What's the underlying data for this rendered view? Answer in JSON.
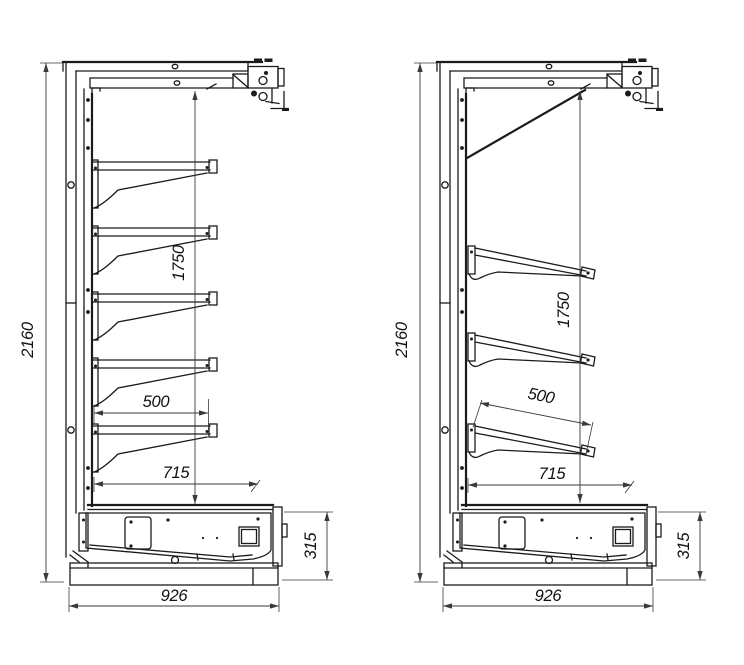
{
  "drawing": {
    "type": "technical-drawing",
    "description": "Two side-section views of a wall shelving / refrigerated multideck unit with dimensions",
    "views": [
      {
        "name": "side-view-horizontal-shelves",
        "shelf_count": 5,
        "dims": {
          "overall_height": "2160",
          "inner_height": "1750",
          "shelf_depth": "500",
          "deck_depth": "715",
          "base_height": "315",
          "overall_depth": "926"
        }
      },
      {
        "name": "side-view-inclined-shelves",
        "shelf_count": 3,
        "dims": {
          "overall_height": "2160",
          "inner_height": "1750",
          "shelf_depth": "500",
          "deck_depth": "715",
          "base_height": "315",
          "overall_depth": "926"
        }
      }
    ],
    "colors": {
      "background": "#ffffff",
      "line": "#1b1b1b",
      "dimension": "#3a3a3a",
      "text": "#111111"
    }
  }
}
